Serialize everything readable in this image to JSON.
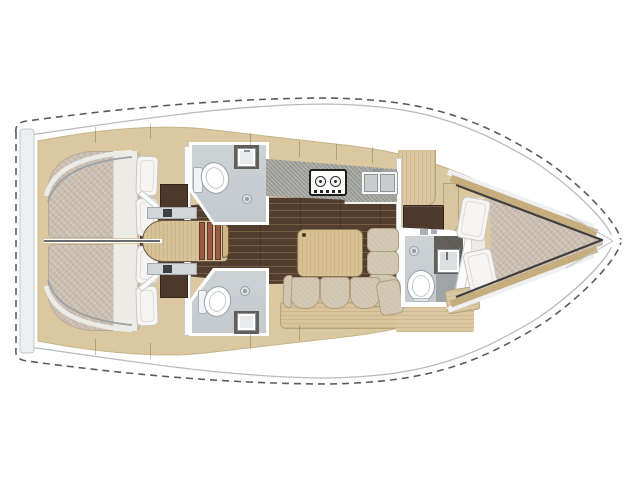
{
  "palette": {
    "background": "#ffffff",
    "hull_outline": "#5b5b5b",
    "deck_line": "#b6bbbf",
    "wood_light": "#dbc7a0",
    "wood_step": "#d7c196",
    "wood_trim": "#c6ad7e",
    "wood_plinth": "#d9c49c",
    "floor_dark": "#523d2e",
    "furniture_dark": "#4c392c",
    "mattress": "#cbbeb1",
    "bedding": "#f6f5f3",
    "bath_floor": "#c9ced2",
    "counter_gray": "#a6a6a1",
    "vanity_dark": "#55524c",
    "sofa": "#d0c5ae",
    "stair_tread": "#9c5a44",
    "table_wood": "#d8c294"
  },
  "layout": {
    "view": "top-down-floor-plan",
    "orientation": "bow-right",
    "areas": [
      "aft-cabin-port",
      "aft-cabin-starboard",
      "companionway",
      "head-port",
      "head-starboard",
      "galley",
      "salon",
      "forward-head",
      "forward-cabin"
    ]
  },
  "fixtures": {
    "galley": [
      "two-burner-stove",
      "double-sink"
    ],
    "heads": [
      "toilet",
      "washbasin",
      "floor-drain",
      "shower"
    ],
    "salon": [
      "table",
      "l-shaped-settee"
    ],
    "cabins": [
      "double-berth",
      "pillows",
      "wardrobe"
    ]
  }
}
